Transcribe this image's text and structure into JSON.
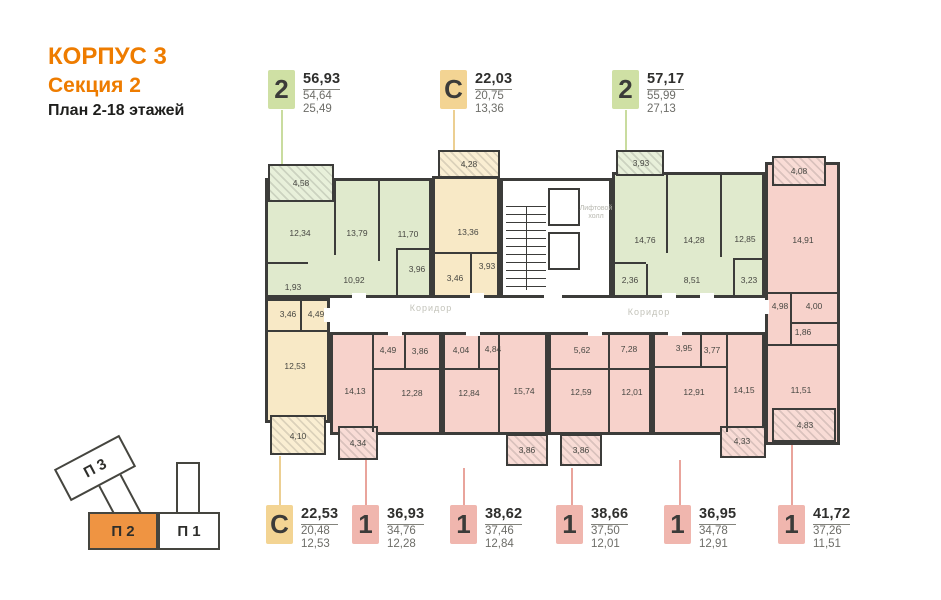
{
  "header": {
    "building": "КОРПУС 3",
    "section": "Секция 2",
    "plan": "План 2-18 этажей"
  },
  "apartment_labels": {
    "top": [
      {
        "type": "2",
        "total": "56,93",
        "area": "54,64",
        "living": "25,49"
      },
      {
        "type": "С",
        "total": "22,03",
        "area": "20,75",
        "living": "13,36"
      },
      {
        "type": "2",
        "total": "57,17",
        "area": "55,99",
        "living": "27,13"
      }
    ],
    "bottom": [
      {
        "type": "С",
        "total": "22,53",
        "area": "20,48",
        "living": "12,53"
      },
      {
        "type": "1",
        "total": "36,93",
        "area": "34,76",
        "living": "12,28"
      },
      {
        "type": "1",
        "total": "38,62",
        "area": "37,46",
        "living": "12,84"
      },
      {
        "type": "1",
        "total": "38,66",
        "area": "37,50",
        "living": "12,01"
      },
      {
        "type": "1",
        "total": "36,95",
        "area": "34,78",
        "living": "12,91"
      },
      {
        "type": "1",
        "total": "41,72",
        "area": "37,26",
        "living": "11,51"
      }
    ]
  },
  "plan": {
    "corridor_label": "Коридор",
    "elevator_hall_label": "Лифтовой холл",
    "apt_top_left": {
      "rooms": {
        "balcony": "4,58",
        "kitchen": "12,34",
        "bedroom1": "13,79",
        "bedroom2": "11,70",
        "hall": "10,92",
        "bath": "3,96",
        "wc": "1,93"
      }
    },
    "apt_top_studio": {
      "rooms": {
        "balcony": "4,28",
        "main": "13,36",
        "hall": "3,93",
        "bath": "3,46"
      }
    },
    "apt_top_right": {
      "rooms": {
        "balcony": "3,93",
        "kitchen": "14,76",
        "bedroom1": "14,28",
        "bedroom2": "12,85",
        "hall": "8,51",
        "wc": "2,36",
        "bath": "3,23"
      }
    },
    "apt_right": {
      "rooms": {
        "balcony_top": "4,08",
        "kitchen": "14,91",
        "hall": "4,98",
        "bath": "4,00",
        "wc": "1,86",
        "bedroom": "11,51",
        "balcony_bottom": "4,83"
      }
    },
    "apt_bottom_studio": {
      "rooms": {
        "bath": "3,46",
        "hall": "4,49",
        "main": "12,53",
        "balcony": "4,10"
      }
    },
    "apt_bottom_1": {
      "rooms": {
        "kitchen": "14,13",
        "hall": "4,49",
        "bath": "3,86",
        "bedroom": "12,28",
        "balcony": "4,34"
      }
    },
    "apt_bottom_2": {
      "rooms": {
        "bath": "4,04",
        "hall": "4,84",
        "bedroom": "12,84",
        "kitchen": "15,74",
        "balcony": "3,86"
      }
    },
    "apt_bottom_3": {
      "rooms": {
        "bath": "5,62",
        "hall": "7,28",
        "kitchen": "12,59",
        "bedroom": "12,01",
        "balcony": "3,86"
      }
    },
    "apt_bottom_4": {
      "rooms": {
        "bath": "3,95",
        "hall": "3,77",
        "bedroom": "12,91",
        "kitchen": "14,15",
        "balcony": "4,33"
      }
    }
  },
  "minimap": {
    "sections": [
      {
        "label": "П 3"
      },
      {
        "label": "П 2"
      },
      {
        "label": "П 1"
      }
    ],
    "highlighted": "П 2"
  },
  "colors": {
    "accent": "#ee7c00",
    "green_fill": "#e0eacd",
    "green_badge": "#cfe0a4",
    "yellow_fill": "#f8e9c6",
    "yellow_badge": "#f3d493",
    "red_fill": "#f7d2cb",
    "red_badge": "#f0b6ae",
    "wall": "#3c3c3a",
    "minimap_orange": "#ef9442"
  }
}
